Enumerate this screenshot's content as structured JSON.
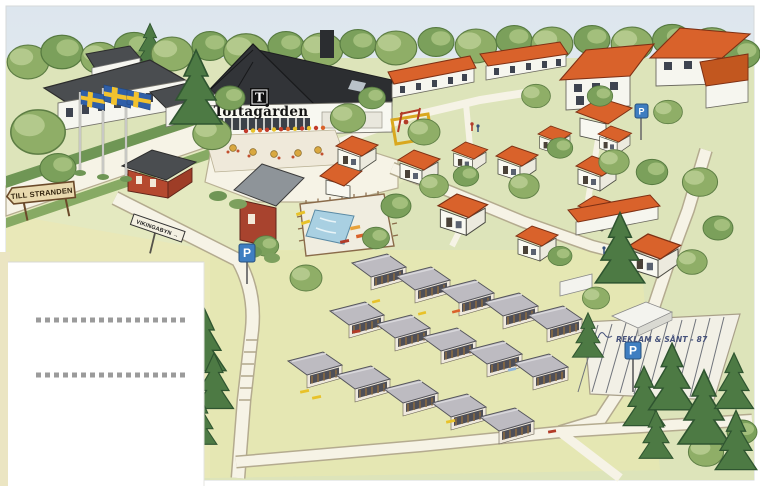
{
  "resort": {
    "name": "Toftagården",
    "logo_letter": "T"
  },
  "signs": {
    "till_stranden": "TILL STRANDEN",
    "vikingabyn": "VIKINGABYN →",
    "parking": "P"
  },
  "signature": "REKLAM & SÅNT - 87",
  "colors": {
    "sky": "#e2e9ef",
    "grass": "#dde4ba",
    "grass_light": "#e8e8b8",
    "path": "#f6f3e6",
    "roof_orange": "#d9622b",
    "roof_dark": "#323438",
    "roof_gray": "#bdbbc1",
    "barn_red": "#a8432e",
    "wall_white": "#f8f8f1",
    "pool_water": "#a9d0e2",
    "foliage": "#8fae67",
    "foliage_dark": "#4d7a44",
    "flag_blue": "#2f5fa8",
    "flag_yellow": "#f2c22e",
    "parking_blue": "#3f7ec1",
    "sign_board": "#e9d9ae",
    "dotted_line": "#9b9b9b"
  }
}
